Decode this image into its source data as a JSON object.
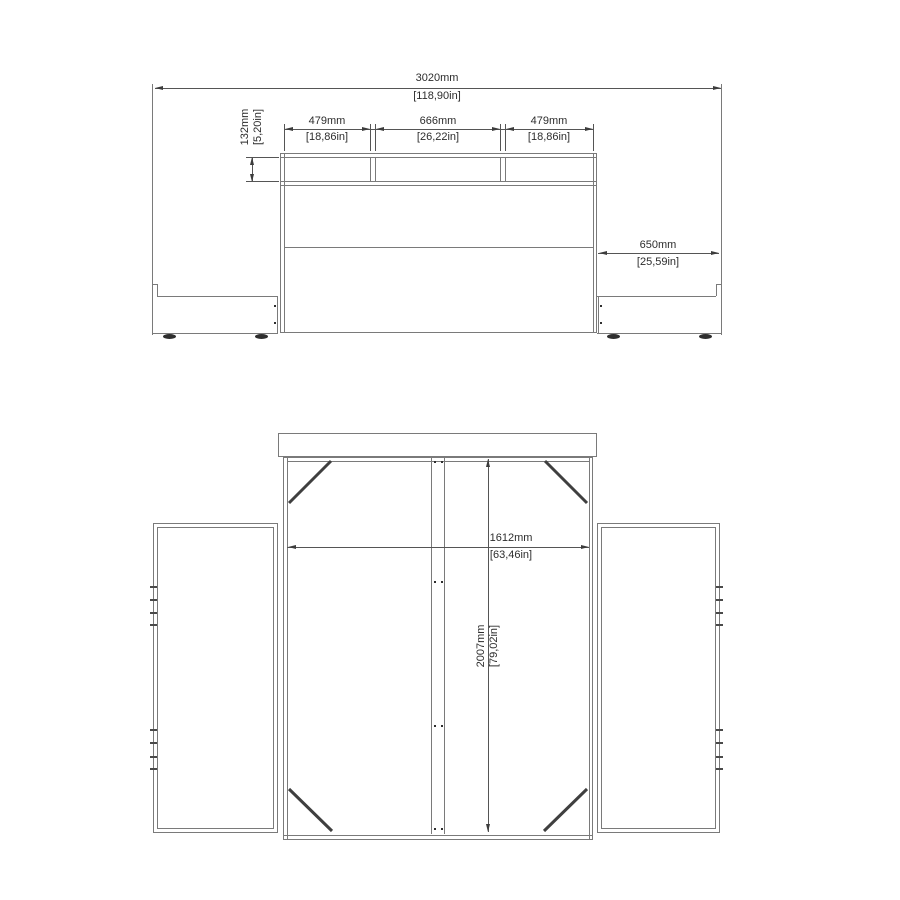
{
  "colors": {
    "background": "#ffffff",
    "object_line": "#7a7a7a",
    "dimension_line": "#555555",
    "arrow": "#3c3c3c",
    "text": "#2d2d2d",
    "brace": "#3f3f3f"
  },
  "front_view": {
    "total_width": {
      "mm": "3020mm",
      "in": "[118,90in]"
    },
    "shelf_height": {
      "mm": "132mm",
      "in": "[5,20in]"
    },
    "shelf_left": {
      "mm": "479mm",
      "in": "[18,86in]"
    },
    "shelf_center": {
      "mm": "666mm",
      "in": "[26,22in]"
    },
    "shelf_right": {
      "mm": "479mm",
      "in": "[18,86in]"
    },
    "side_unit_width": {
      "mm": "650mm",
      "in": "[25,59in]"
    }
  },
  "top_view": {
    "inner_width": {
      "mm": "1612mm",
      "in": "[63,46in]"
    },
    "length": {
      "mm": "2007mm",
      "in": "[79,02in]"
    }
  }
}
